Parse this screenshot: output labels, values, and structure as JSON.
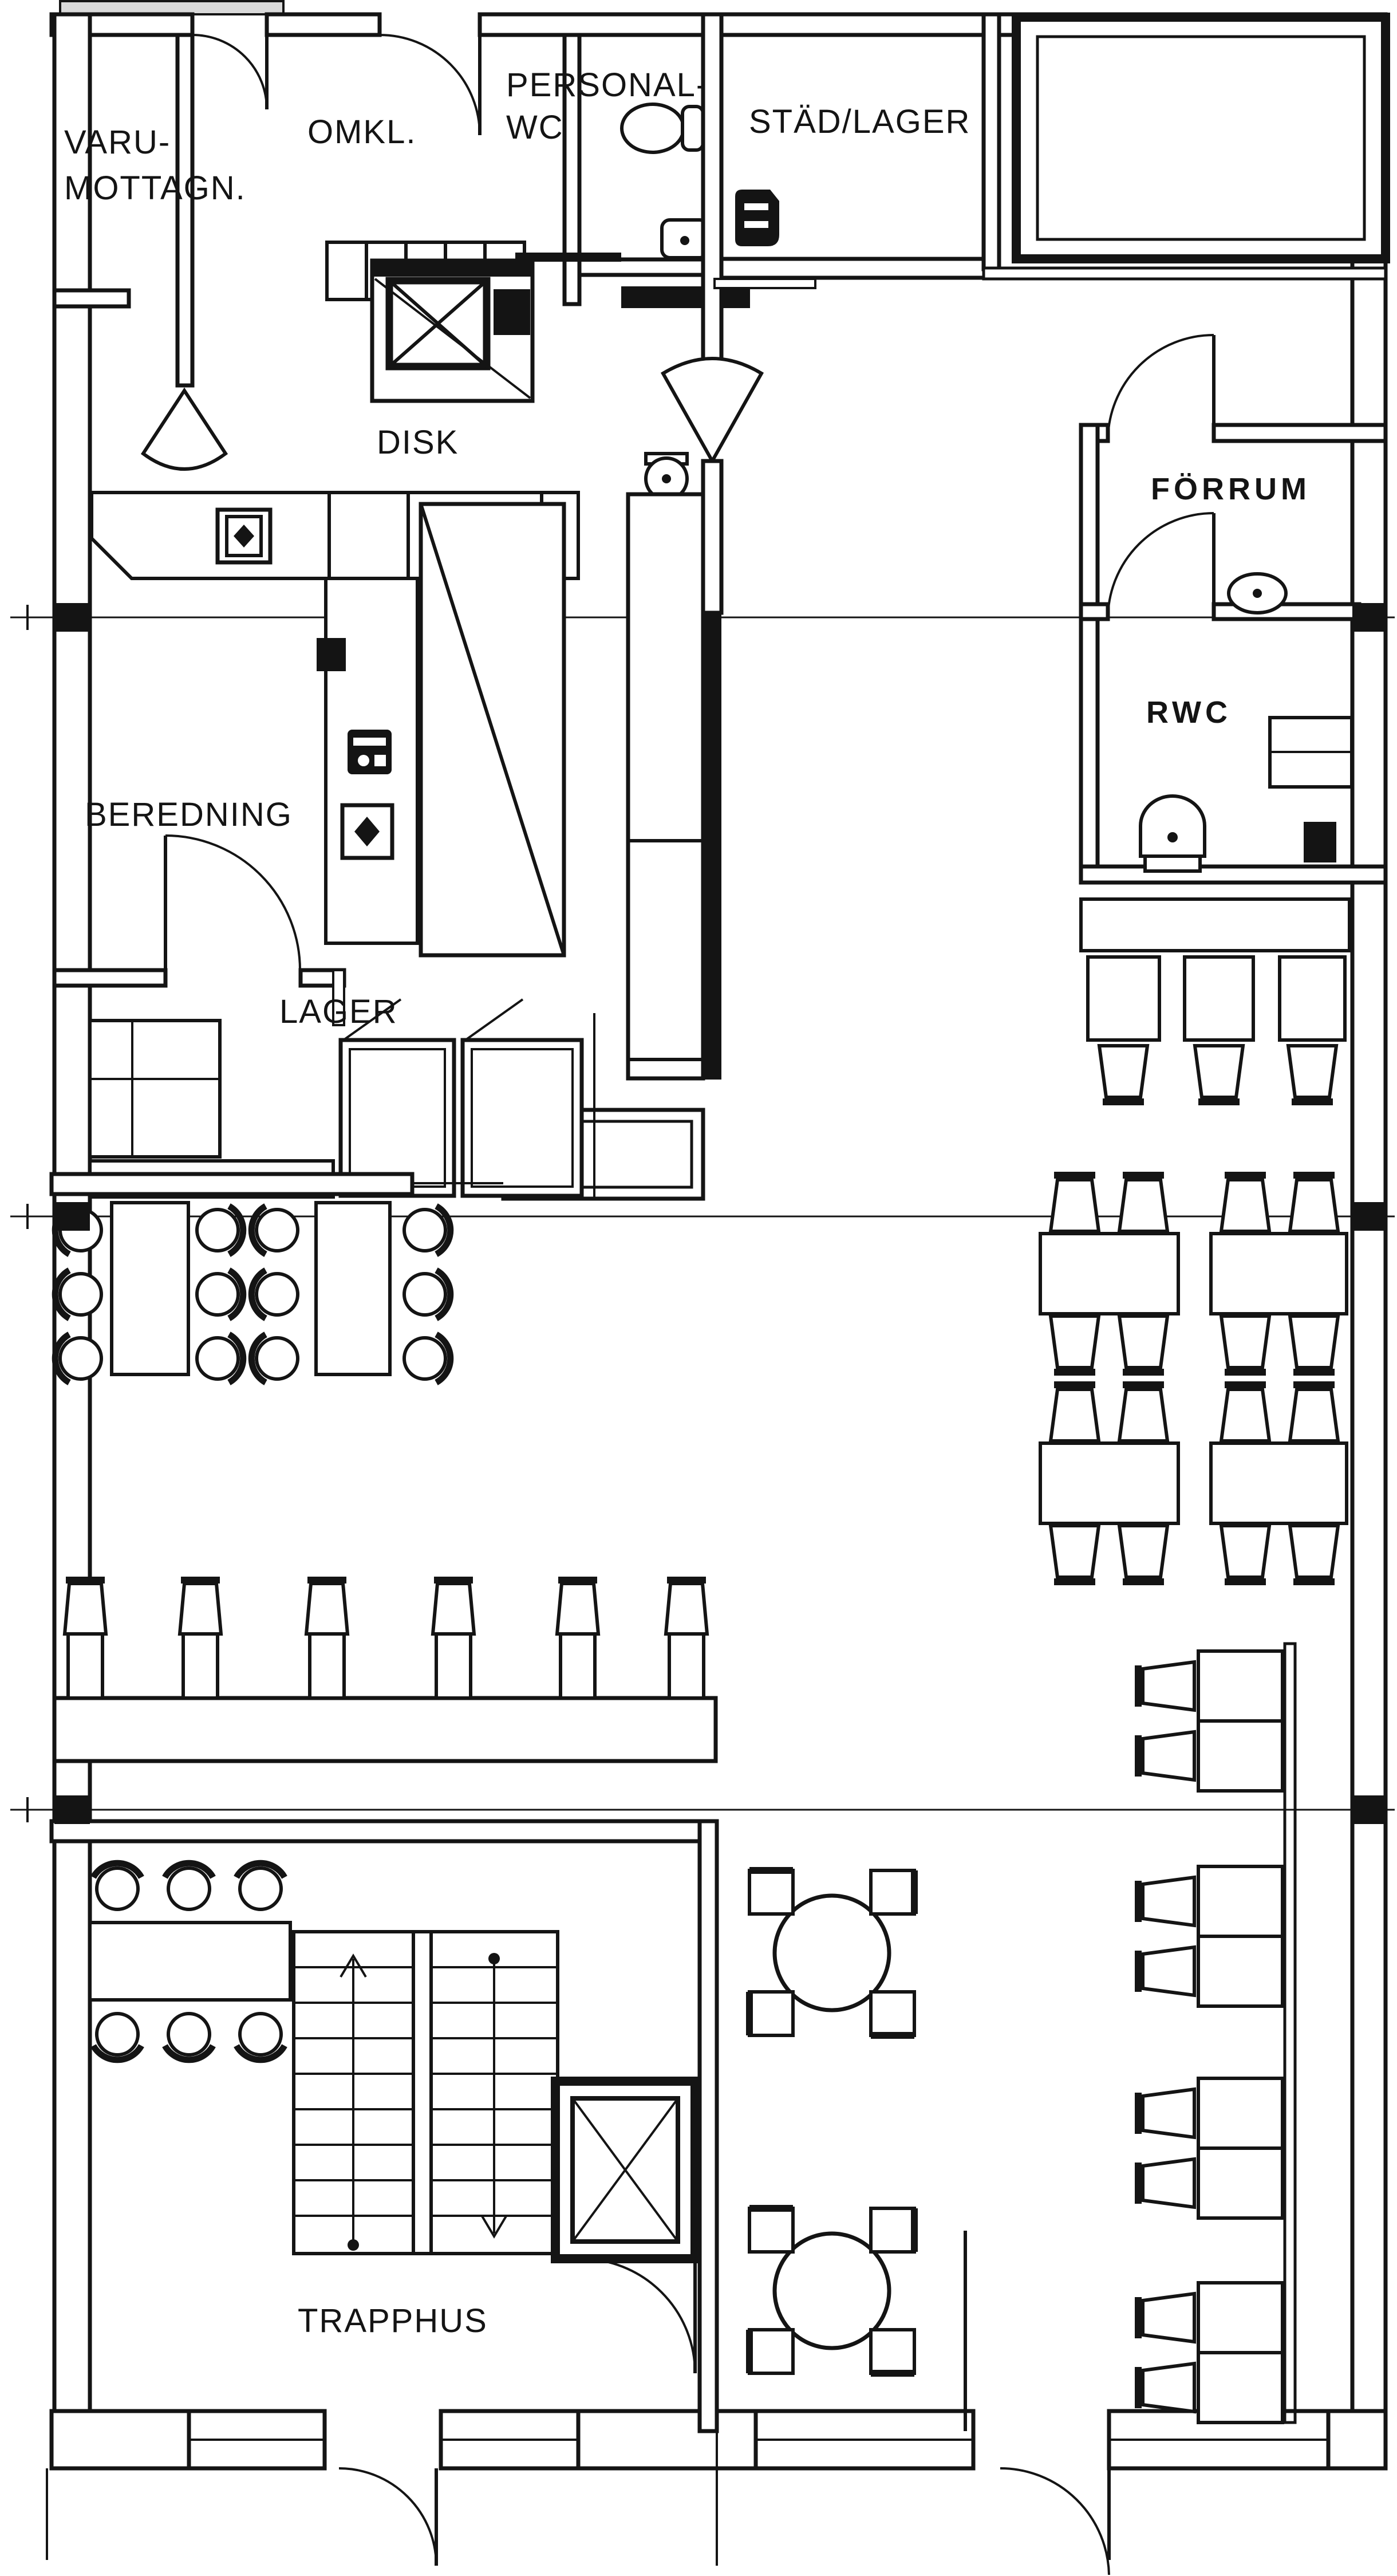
{
  "document": {
    "type": "architectural-floor-plan",
    "language": "sv"
  },
  "rooms": {
    "varumottagn": {
      "line1": "VARU-",
      "line2": "MOTTAGN."
    },
    "omkl": {
      "label": "OMKL."
    },
    "personalwc": {
      "line1": "PERSONAL-",
      "line2": "WC"
    },
    "stadlager": {
      "label": "STÄD/LAGER"
    },
    "disk": {
      "label": "DISK"
    },
    "forrum": {
      "label": "FÖRRUM"
    },
    "rwc": {
      "label": "RWC"
    },
    "beredning": {
      "label": "BEREDNING"
    },
    "lager": {
      "label": "LAGER"
    },
    "trapphus": {
      "label": "TRAPPHUS"
    }
  },
  "legend": {
    "icons": [
      "door-swing-icon",
      "double-swing-door-icon",
      "toilet-icon",
      "washbasin-icon",
      "mop-sink-icon",
      "dumbwaiter-icon",
      "elevator-icon",
      "stairs-icon",
      "round-chair-icon",
      "chair-icon",
      "bar-stool-icon",
      "diamond-chair-icon",
      "round-table-icon",
      "table-icon",
      "locker-icon",
      "chest-freezer-icon",
      "appliance-icon",
      "counter-icon",
      "window-icon",
      "reference-line-icon"
    ]
  },
  "furniture_counts": {
    "left_dining_tables": 2,
    "left_dining_round_chairs": 12,
    "bar_stools": 6,
    "right_grid_tables": 4,
    "right_wall_table_groups": 4,
    "round_tables": 2,
    "small_tables_below_rwc": 3,
    "trapphus_table_seats": 6,
    "chest_freezers": 2
  },
  "colors": {
    "ink": "#141414",
    "paper": "#ffffff",
    "dock": "#d9d9d9"
  }
}
